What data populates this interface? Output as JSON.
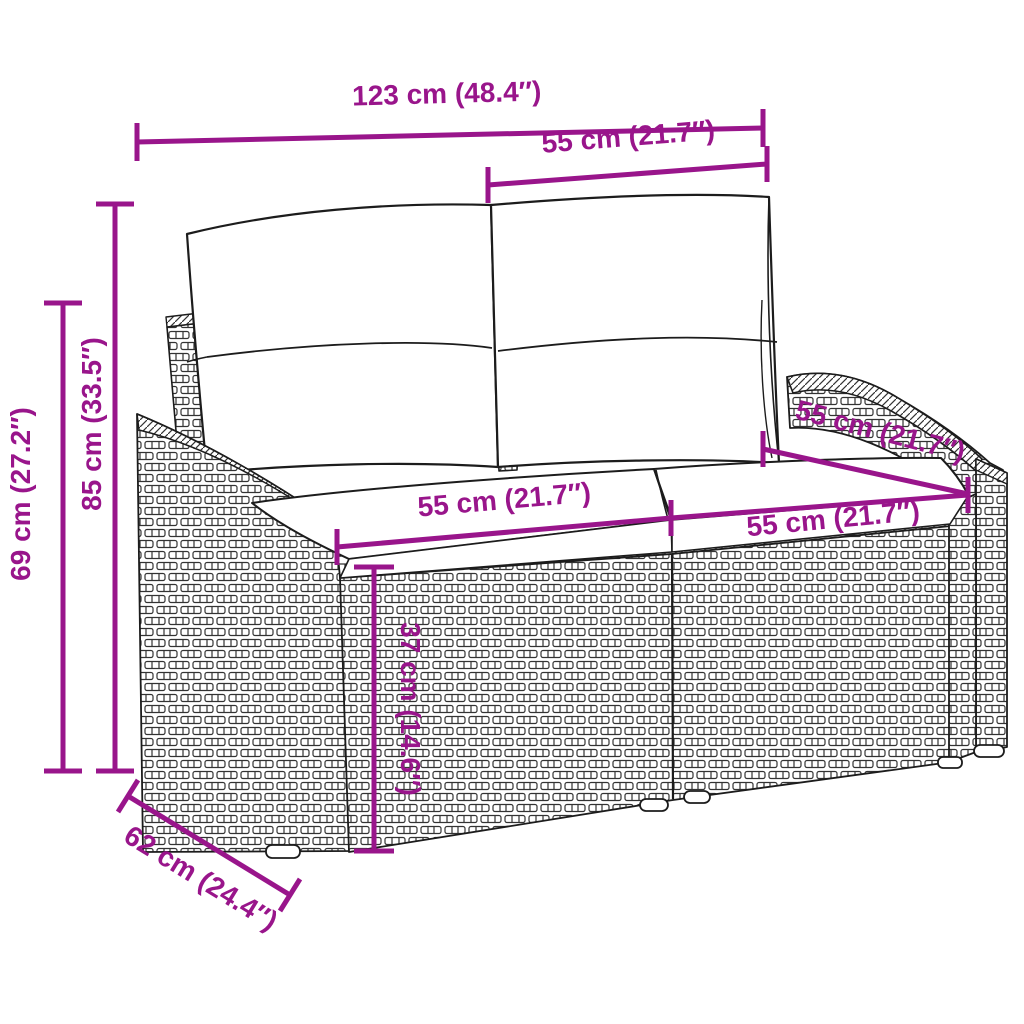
{
  "diagram": {
    "subject": "rattan-two-seater-garden-sofa-with-cushions",
    "background_color": "#ffffff",
    "outline_color": "#1c1c1c",
    "dimension_color": "#99158b",
    "dimensions": {
      "overall_width": "123 cm (48.4″)",
      "back_section_width": "55 cm (21.7″)",
      "overall_height": "85 cm (33.5″)",
      "armrest_height": "69 cm (27.2″)",
      "seat_width_left": "55 cm (21.7″)",
      "seat_width_right": "55 cm (21.7″)",
      "seat_depth": "55 cm (21.7″)",
      "seat_height": "37 cm (14.6″)",
      "overall_depth": "62 cm (24.4″)"
    }
  }
}
